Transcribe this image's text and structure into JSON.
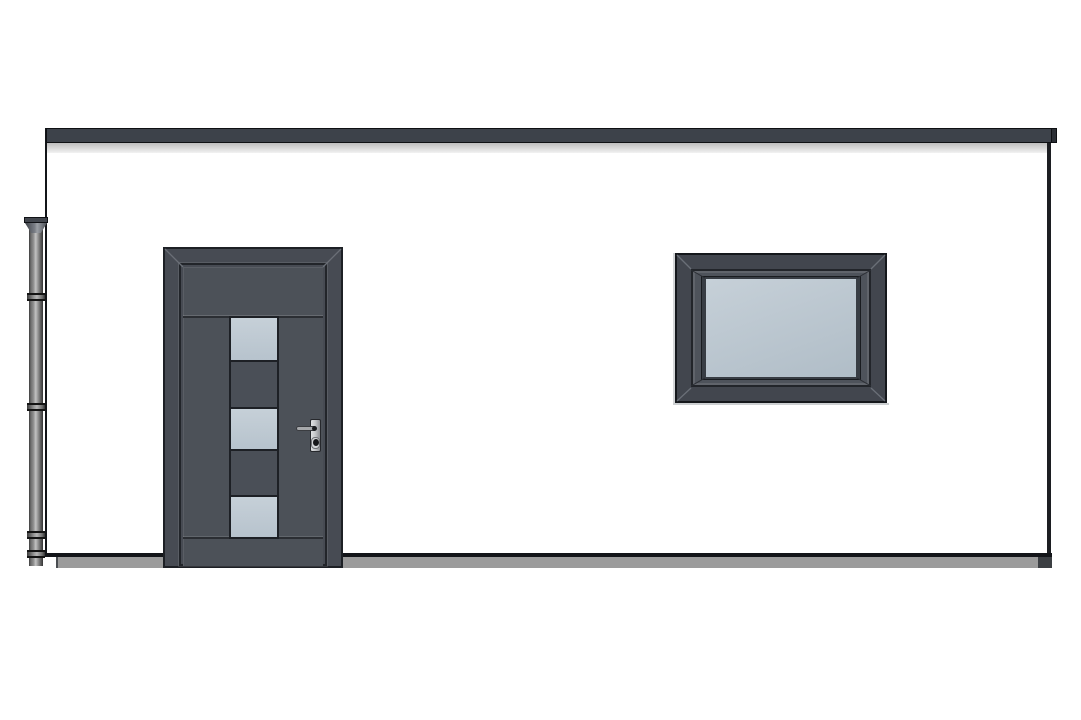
{
  "scene": {
    "type": "architectural-elevation-drawing",
    "subject": "front elevation of a single-storey flat-roof building with an entrance door, one window and a rainwater downpipe",
    "background_color": "#ffffff"
  },
  "colors": {
    "background": "#ffffff",
    "fascia_bar": "#3d424a",
    "fascia_outline": "#0e1013",
    "fascia_shadow_top": "#bdbdbd",
    "fascia_shadow_bottom": "#f2f2f2",
    "wall_outline": "#131519",
    "plinth": "#9b9b9b",
    "plinth_end_cap": "#3c3f43",
    "door_frame": "#474b53",
    "door_leaf": "#4c5158",
    "door_glass": "#b7c3cd",
    "door_panel": "#4a4f57",
    "dark_outline": "#1d2025",
    "mitre_light": "#6a6f77",
    "window_frame": "#42464e",
    "window_sash": "#4e535b",
    "window_inner": "#383d44",
    "window_glass_top": "#c6d0d8",
    "window_glass_bottom": "#b0bdc7",
    "pipe_dark": "#3e3e3e",
    "pipe_mid": "#8f8f8f",
    "pipe_light": "#c2c2c2",
    "handle_plate": "#c6c8cb",
    "handle_lever": "#a6a8ab",
    "handle_dark": "#26282c"
  },
  "roof": {
    "overhang_side": "right"
  },
  "door": {
    "glass_panel_count": 3,
    "sections": [
      {
        "kind": "glass",
        "height": 42
      },
      {
        "kind": "panel",
        "height": 47
      },
      {
        "kind": "glass",
        "height": 42
      },
      {
        "kind": "panel",
        "height": 46
      },
      {
        "kind": "glass",
        "height": 42
      }
    ],
    "hardware": [
      "lever-handle",
      "spindle",
      "keyhole"
    ]
  },
  "window": {
    "panes": 1,
    "glazing": "frosted"
  },
  "downpipe": {
    "has_hopper_head": true,
    "coupling_tops": [
      293,
      403,
      531,
      550
    ]
  }
}
